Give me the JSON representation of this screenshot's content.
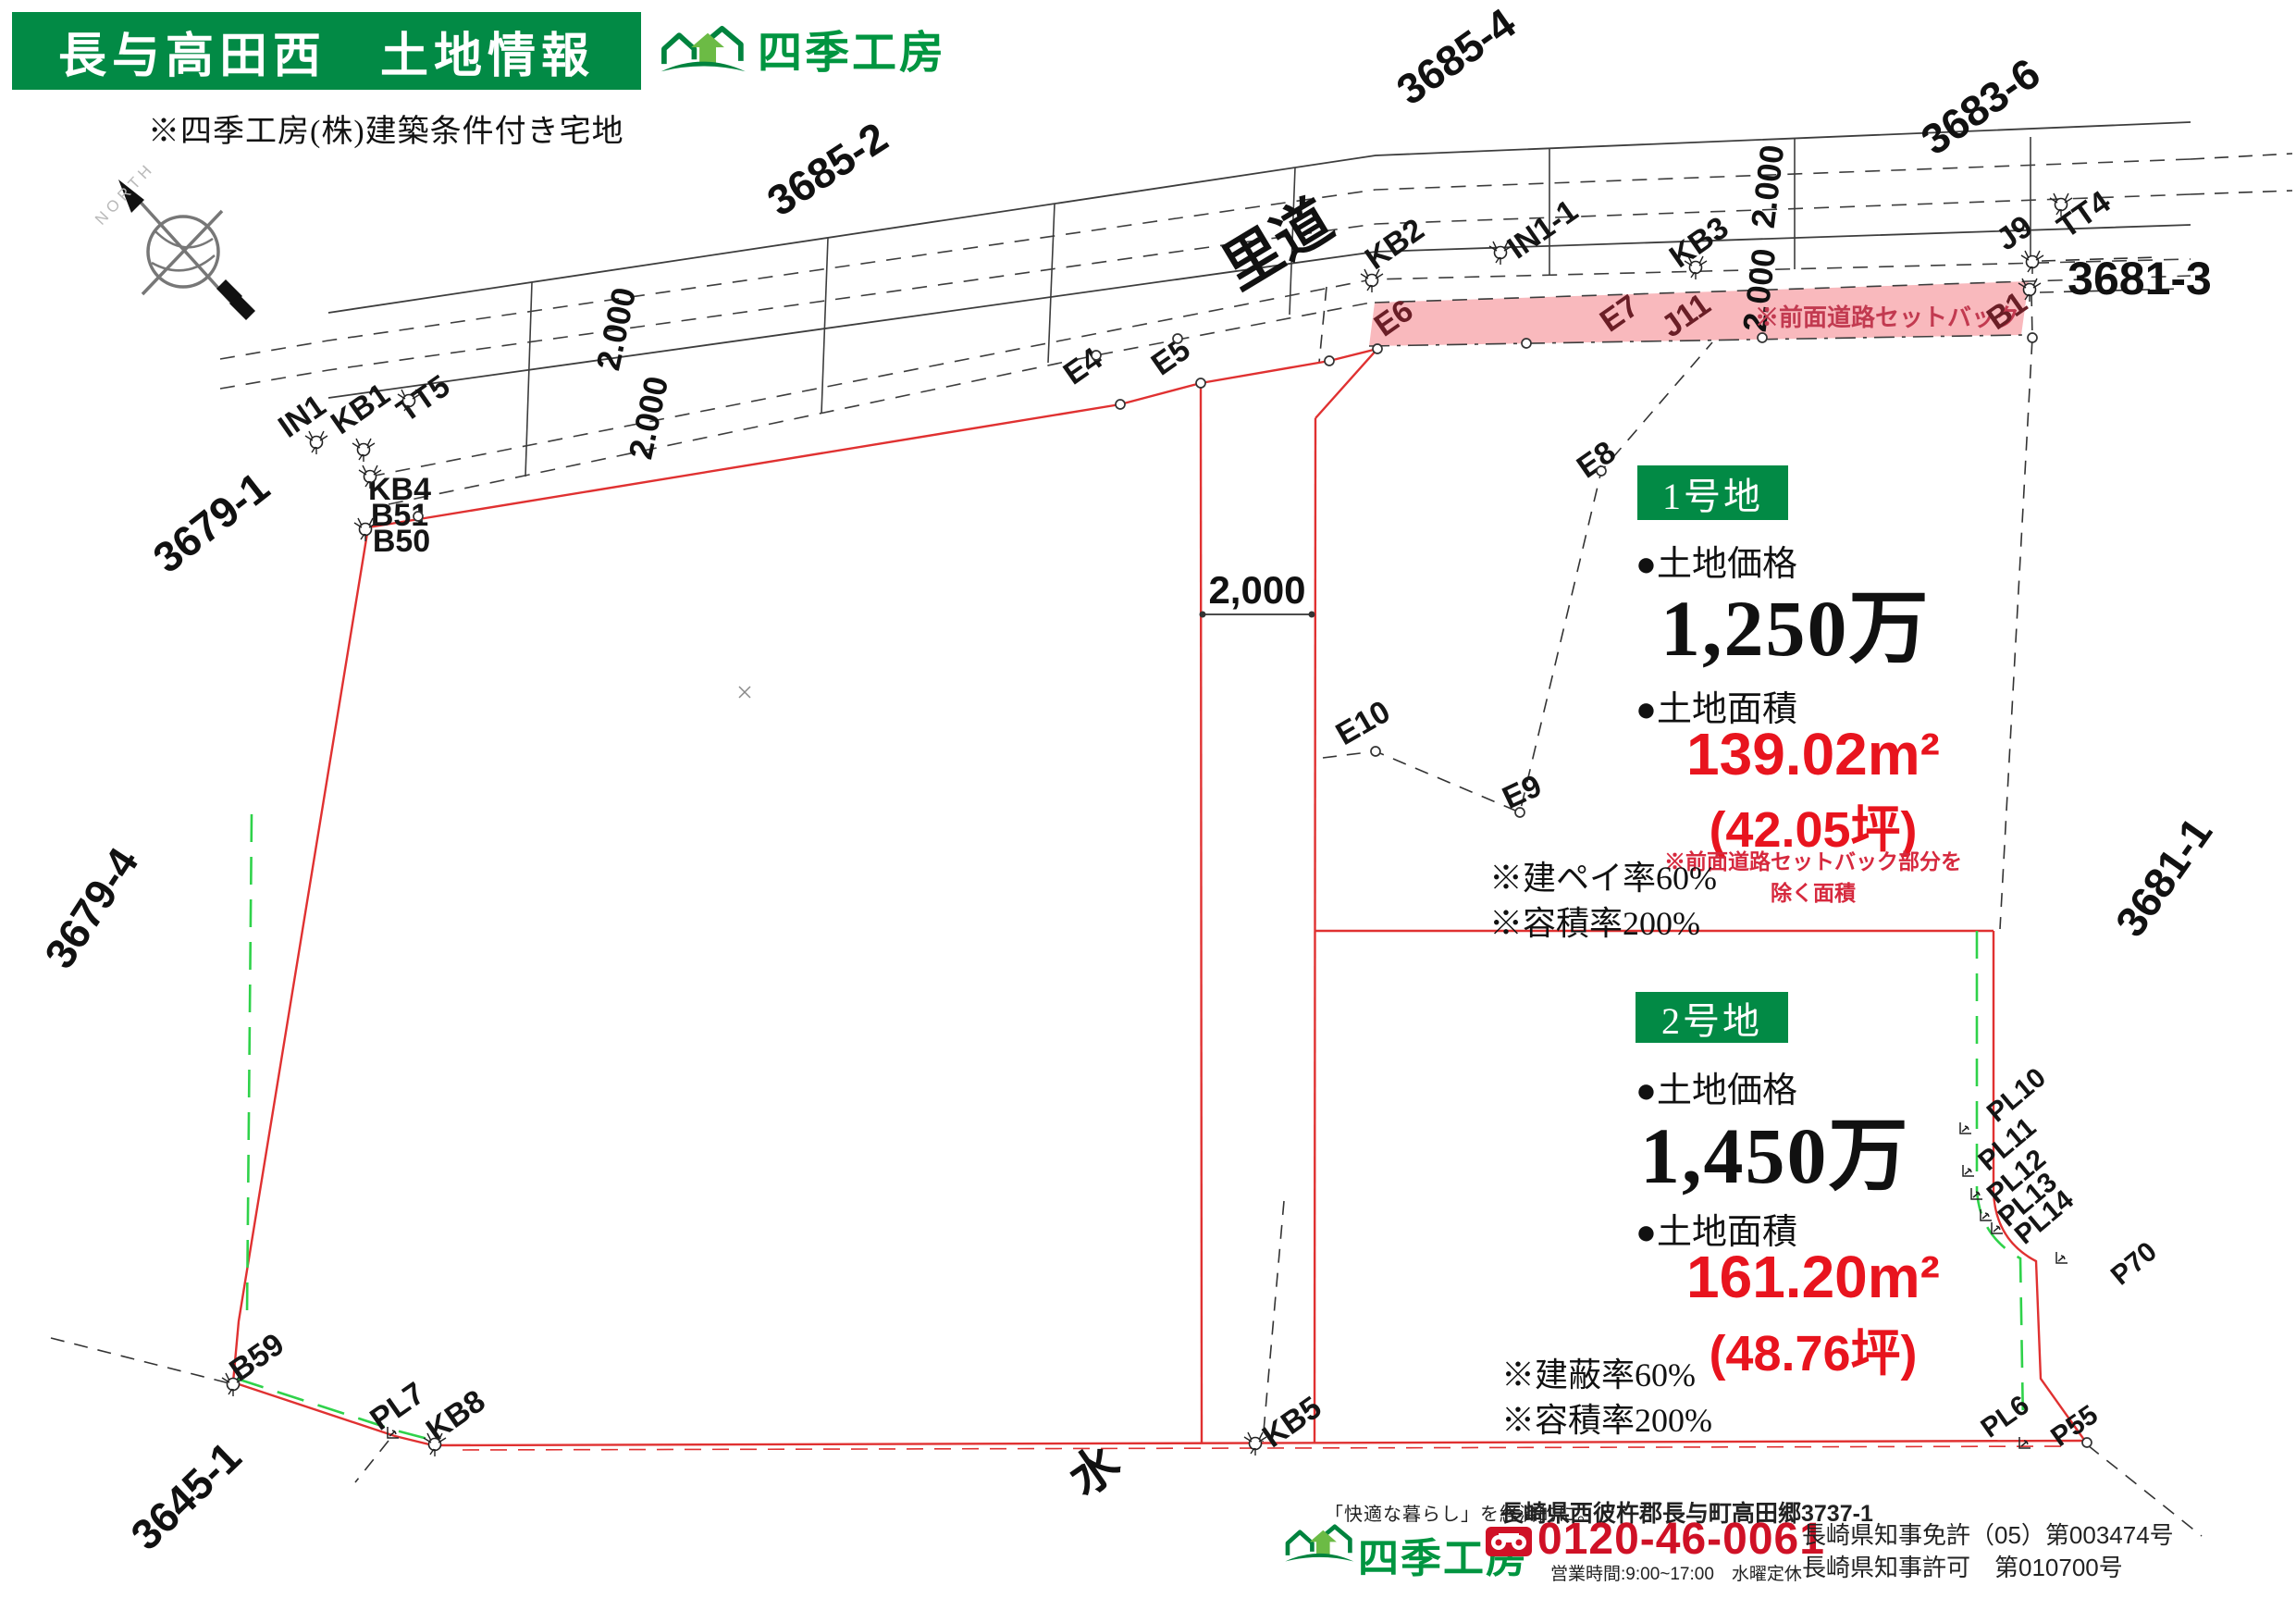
{
  "header": {
    "title": "長与高田西　土地情報",
    "note": "※四季工房(株)建築条件付き宅地",
    "brand": "四季工房"
  },
  "compass": {
    "label": "NORTH"
  },
  "map": {
    "road_label": "里道",
    "water_label": "水",
    "setback_label": "※前面道路セットバック",
    "dim_horizontal": "2,000",
    "dims": [
      {
        "label": "2.000"
      },
      {
        "label": "2.000"
      },
      {
        "label": "2.000"
      },
      {
        "label": "2.000"
      }
    ],
    "parcels": [
      {
        "label": "3685-2"
      },
      {
        "label": "3685-4"
      },
      {
        "label": "3683-6"
      },
      {
        "label": "3681-3"
      },
      {
        "label": "3679-1"
      },
      {
        "label": "3679-4"
      },
      {
        "label": "3645-1"
      },
      {
        "label": "3681-1"
      }
    ],
    "points": [
      {
        "label": "IN1"
      },
      {
        "label": "KB1"
      },
      {
        "label": "TT5"
      },
      {
        "label": "KB4"
      },
      {
        "label": "B51"
      },
      {
        "label": "B50"
      },
      {
        "label": "E4"
      },
      {
        "label": "E5"
      },
      {
        "label": "E6"
      },
      {
        "label": "KB2"
      },
      {
        "label": "IN1-1"
      },
      {
        "label": "E7"
      },
      {
        "label": "J11"
      },
      {
        "label": "KB3"
      },
      {
        "label": "J9"
      },
      {
        "label": "TT4"
      },
      {
        "label": "B1"
      },
      {
        "label": "E8"
      },
      {
        "label": "E10"
      },
      {
        "label": "E9"
      },
      {
        "label": "B59"
      },
      {
        "label": "PL7"
      },
      {
        "label": "KB8"
      },
      {
        "label": "KB5"
      },
      {
        "label": "PL10"
      },
      {
        "label": "PL11"
      },
      {
        "label": "PL12"
      },
      {
        "label": "PL13"
      },
      {
        "label": "PL14"
      },
      {
        "label": "P70"
      },
      {
        "label": "PL6"
      },
      {
        "label": "P55"
      }
    ]
  },
  "lot1": {
    "badge": "1号地",
    "price_label": "●土地価格",
    "price": "1,250万",
    "area_label": "●土地面積",
    "area_value": "139.02",
    "area_unit": "m²",
    "area_tsubo": "(42.05坪)",
    "area_note": "※前面道路セットバック部分を除く面積",
    "coverage": "※建ペイ率60%",
    "far": "※容積率200%"
  },
  "lot2": {
    "badge": "2号地",
    "price_label": "●土地価格",
    "price": "1,450万",
    "area_label": "●土地面積",
    "area_value": "161.20",
    "area_unit": "m²",
    "area_tsubo": "(48.76坪)",
    "coverage": "※建蔽率60%",
    "far": "※容積率200%"
  },
  "footer": {
    "tagline": "「快適な暮らし」を経済的に。",
    "brand": "四季工房",
    "address": "長崎県西彼杵郡長与町高田郷3737-1",
    "phone": "0120-46-0061",
    "hours": "営業時間:9:00~17:00　水曜定休",
    "license1": "長崎県知事免許（05）第003474号",
    "license2": "長崎県知事許可　第010700号"
  }
}
